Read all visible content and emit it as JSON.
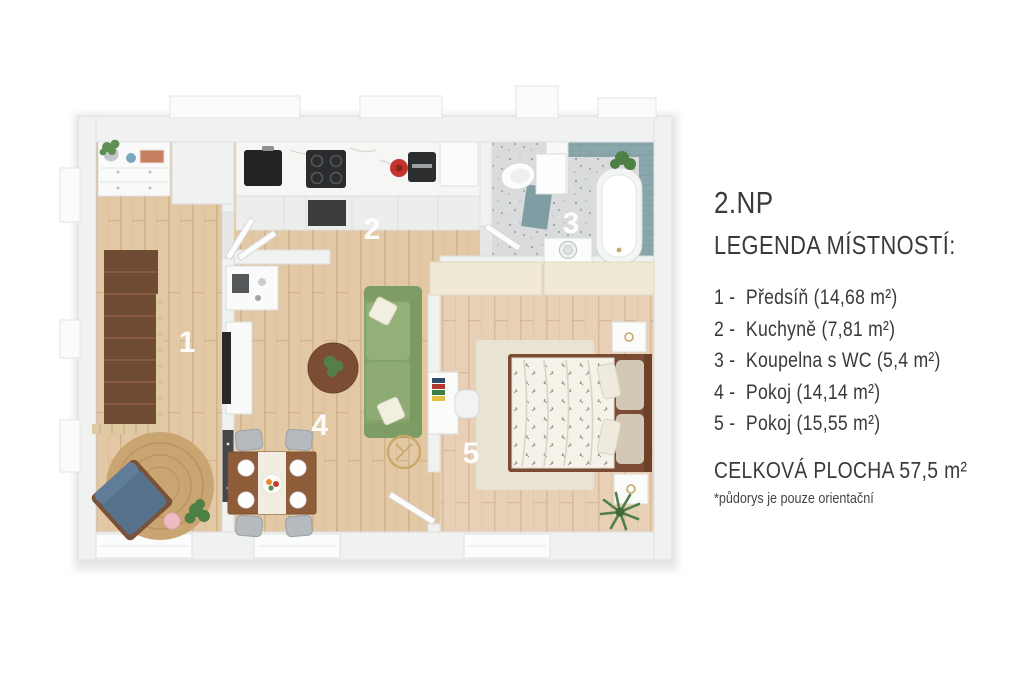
{
  "legend": {
    "floor_label": "2.NP",
    "heading": "LEGENDA MÍSTNOSTÍ:",
    "items": [
      {
        "num": "1 -",
        "text": "Předsíň (14,68 m²)"
      },
      {
        "num": "2 -",
        "text": "Kuchyně (7,81 m²)"
      },
      {
        "num": "3 -",
        "text": "Koupelna s WC (5,4 m²)"
      },
      {
        "num": "4 -",
        "text": "Pokoj (14,14 m²)"
      },
      {
        "num": "5 -",
        "text": "Pokoj (15,55 m²)"
      }
    ],
    "total": "CELKOVÁ PLOCHA 57,5 m²",
    "disclaimer": "*půdorys je pouze orientační"
  },
  "plan": {
    "rooms": [
      {
        "label": "1",
        "name": "Předsíň",
        "area_m2": "14,68"
      },
      {
        "label": "2",
        "name": "Kuchyně",
        "area_m2": "7,81"
      },
      {
        "label": "3",
        "name": "Koupelna s WC",
        "area_m2": "5,4"
      },
      {
        "label": "4",
        "name": "Pokoj",
        "area_m2": "14,14"
      },
      {
        "label": "5",
        "name": "Pokoj",
        "area_m2": "15,55"
      }
    ],
    "total_area_m2": "57,5",
    "colors": {
      "wall": "#f0f1f1",
      "wood_floor": "#e3c8a5",
      "wood_floor_bedroom": "#e8d0b6",
      "bathroom_floor": "#d9dbdc",
      "tile_teal": "#8aa7ac",
      "stairs_brown": "#6f4b34",
      "sofa_green": "#8dab72",
      "armchair_blue": "#56718c",
      "rug_jute": "#c9a572",
      "accent_gold": "#c8a968",
      "label_text": "#ffffff",
      "legend_text": "#3a3a3a"
    }
  }
}
